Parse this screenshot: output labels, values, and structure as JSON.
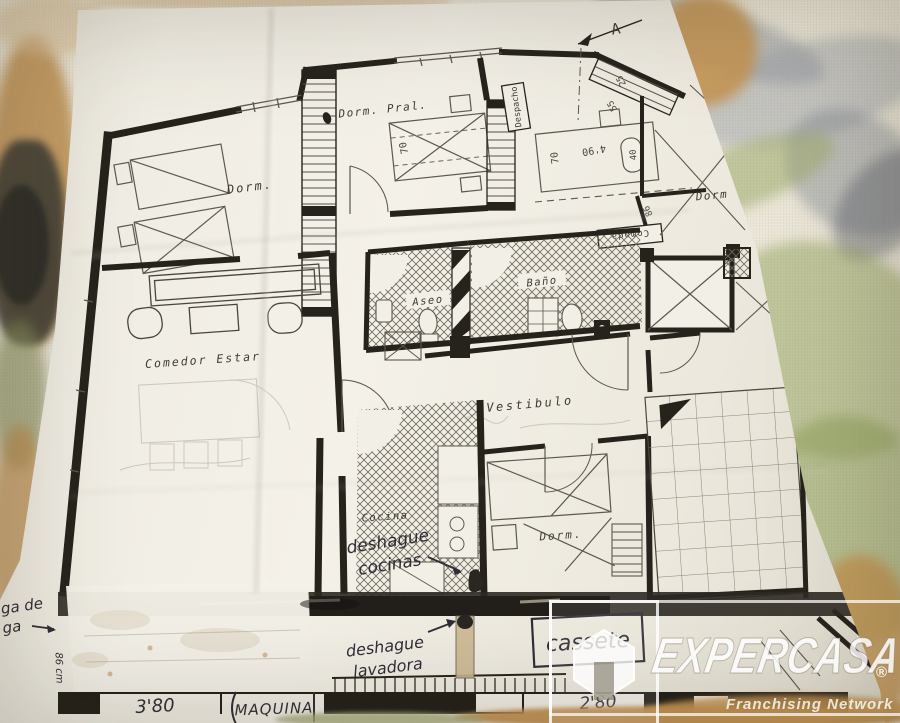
{
  "plan": {
    "marker_a": "A",
    "rooms": {
      "dorm_tl": "Dorm.",
      "dorm_pral": "Dorm. Pral.",
      "despacho": "Despacho",
      "dorm_right": "Dorm",
      "aseo": "Aseo",
      "bano": "Baño",
      "comedor": "Comedor Estar",
      "vestibulo": "Vestibulo",
      "cocina": "Cocina",
      "dorm_bottom": "Dorm."
    },
    "dims": {
      "d490": "4'90",
      "d70_right": "70",
      "d70_pral": "70",
      "d25": "25",
      "d55": "55",
      "d40": "40",
      "d86": "86",
      "d86cm": "86 cm",
      "d380": "3'80",
      "d280": "2'80"
    },
    "boxed": {
      "comoda": "Comoda",
      "cassete": "cassete",
      "maquina": "MAQUINA"
    },
    "hand": {
      "dc1": "deshague",
      "dc2": "cocinas",
      "dl1": "deshague",
      "dl2": "lavadora",
      "note1": "ga de",
      "note2": "ga"
    }
  },
  "watermark": {
    "brand": "EXPERCASA",
    "registered": "®",
    "tagline": "Franchising Network"
  }
}
